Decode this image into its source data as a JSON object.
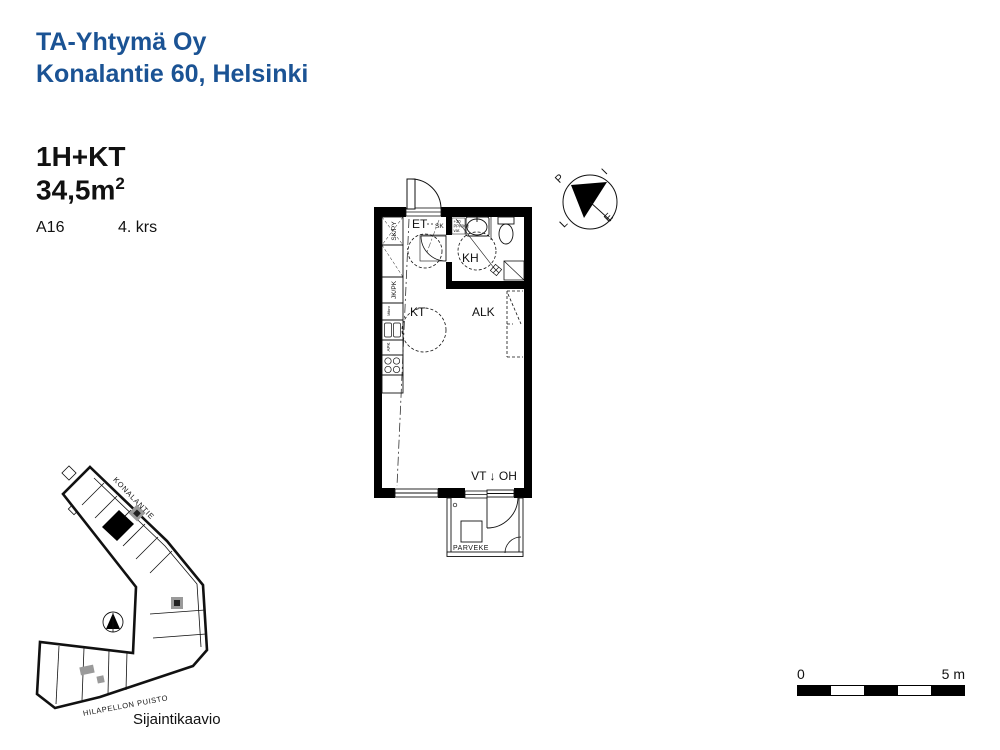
{
  "header": {
    "company": "TA-Yhtymä Oy",
    "address": "Konalantie 60, Helsinki"
  },
  "apartment": {
    "layout": "1H+KT",
    "area_base": "34,5m",
    "area_exponent": "2",
    "unit_id": "A16",
    "floor": "4. krs"
  },
  "floorplan": {
    "rooms": {
      "entry": "ET",
      "bathroom": "KH",
      "kitchen": "KT",
      "alcove": "ALK",
      "balcony": "PARVEKE"
    },
    "annotations": {
      "entry_closet": "SK",
      "vt_oh": "VT ↓ OH",
      "tall_cabinet": "SK/PY",
      "fridge": "JK/PK",
      "microwave": "Mikro",
      "dishwasher": "APK",
      "bath_note_line1": "+30",
      "bath_note_line2": "PPK/KR",
      "bath_note_line3": "var."
    }
  },
  "compass": {
    "north": "P",
    "east": "I",
    "south": "E",
    "west": "L"
  },
  "siteplan": {
    "street_top": "KONALANTIE",
    "street_bottom": "HILAPELLON PUISTO",
    "caption": "Sijaintikaavio"
  },
  "scalebar": {
    "start_label": "0",
    "end_label": "5 m"
  },
  "colors": {
    "brand_blue": "#1b5394",
    "ink": "#000000",
    "stair_gray": "#9a9a9a"
  }
}
